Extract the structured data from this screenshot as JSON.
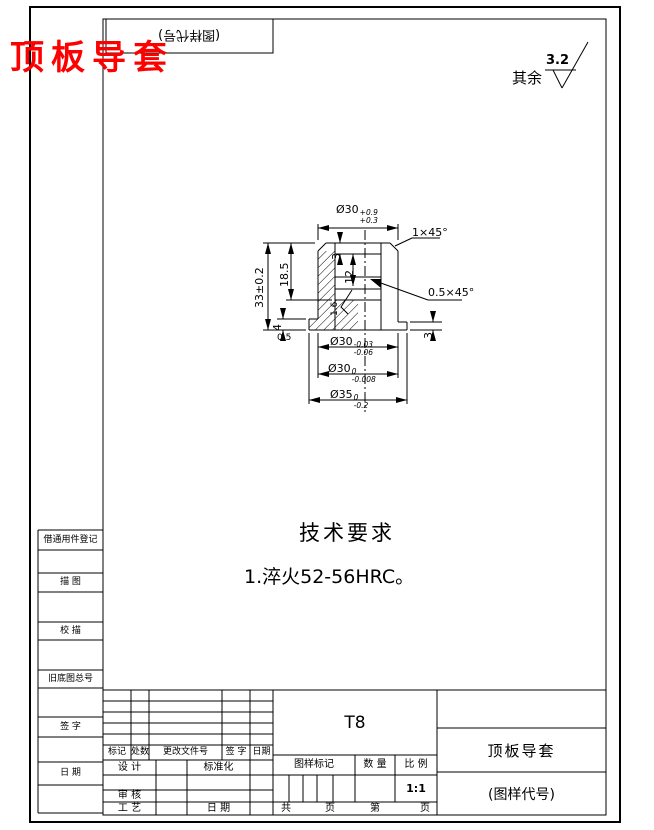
{
  "page": {
    "red_title": "顶板导套"
  },
  "top_box": {
    "code": "(图样代号)"
  },
  "surface_note": {
    "prefix": "其余",
    "value": "3.2"
  },
  "tech_req": {
    "title": "技术要求",
    "item_1": "1.淬火52-56HRC。"
  },
  "drawing": {
    "dims": {
      "od_top_base": "Ø30",
      "od_top_sup": "+0.9",
      "od_top_sub": "+0.3",
      "chamfer_top": "1×45°",
      "chamfer_groove": "0.5×45°",
      "total_height": "33±0.2",
      "upper_height": "18.5",
      "counterbore_depth": "3",
      "groove_depth": "12",
      "bore_roughness": "1.6",
      "flange_height": "4",
      "relief": "0.5",
      "right_step": "3",
      "od_mid_base": "Ø30",
      "od_mid_sup": "-0.03",
      "od_mid_sub": "-0.06",
      "od_low_base": "Ø30",
      "od_low_sup": "0",
      "od_low_sub": "-0.008",
      "od_flange_base": "Ø35",
      "od_flange_sup": "0",
      "od_flange_sub": "-0.2"
    }
  },
  "left_margin": {
    "items": [
      "借通用件登记",
      "描 图",
      "校 描",
      "旧底图总号",
      "签 字",
      "日 期"
    ]
  },
  "title_block": {
    "change_cols": [
      "标记",
      "处数",
      "更改文件号",
      "签 字",
      "日期"
    ],
    "design": "设 计",
    "standardization": "标准化",
    "audit": "审 核",
    "process": "工 艺",
    "date": "日 期",
    "material": "T8",
    "mark_header": "图样标记",
    "qty_header": "数 量",
    "scale_header": "比 例",
    "scale_value": "1:1",
    "total": "共",
    "page1": "页",
    "no": "第",
    "page2": "页",
    "part_name": "顶板导套",
    "code": "(图样代号)"
  }
}
